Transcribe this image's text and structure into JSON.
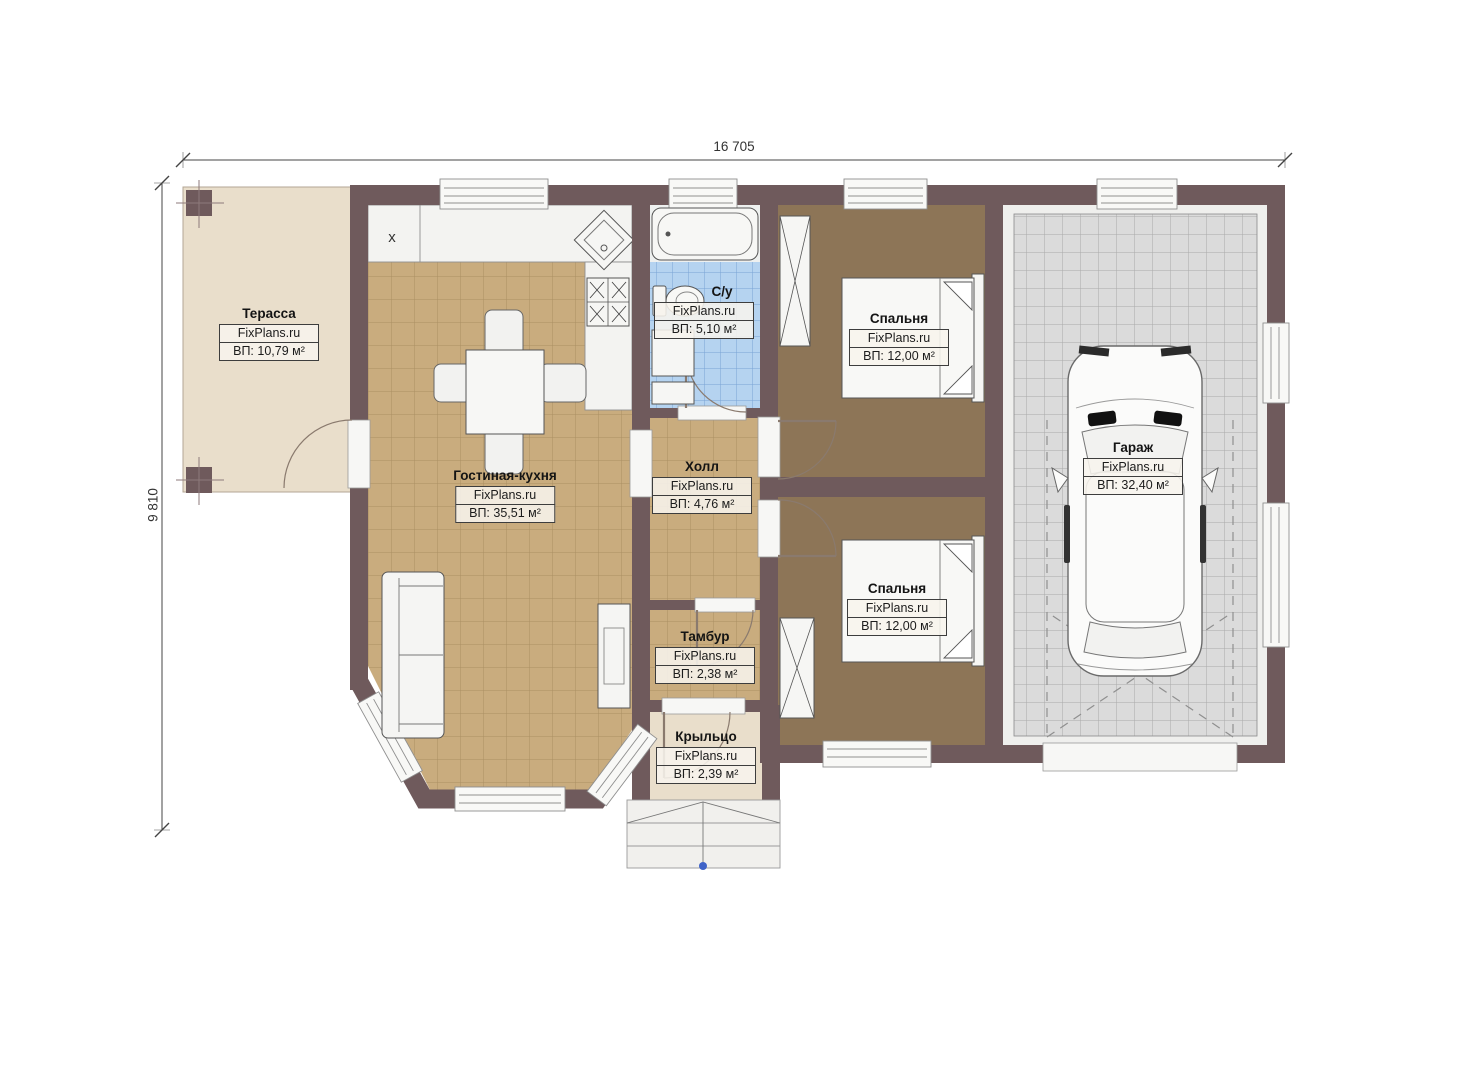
{
  "plan": {
    "brand": "FixPlans.ru",
    "dimensions": {
      "width_label": "16 705",
      "height_label": "9 810"
    },
    "kitchen_marker": "x",
    "rooms": [
      {
        "id": "terrace",
        "name": "Терасса",
        "brand": "FixPlans.ru",
        "area": "ВП: 10,79 м²"
      },
      {
        "id": "living-kitchen",
        "name": "Гостиная-кухня",
        "brand": "FixPlans.ru",
        "area": "ВП: 35,51 м²"
      },
      {
        "id": "bathroom",
        "name": "С/у",
        "brand": "FixPlans.ru",
        "area": "ВП: 5,10 м²"
      },
      {
        "id": "hall",
        "name": "Холл",
        "brand": "FixPlans.ru",
        "area": "ВП: 4,76 м²"
      },
      {
        "id": "bedroom-1",
        "name": "Спальня",
        "brand": "FixPlans.ru",
        "area": "ВП: 12,00 м²"
      },
      {
        "id": "bedroom-2",
        "name": "Спальня",
        "brand": "FixPlans.ru",
        "area": "ВП: 12,00 м²"
      },
      {
        "id": "garage",
        "name": "Гараж",
        "brand": "FixPlans.ru",
        "area": "ВП: 32,40 м²"
      },
      {
        "id": "vestibule",
        "name": "Тамбур",
        "brand": "FixPlans.ru",
        "area": "ВП: 2,38 м²"
      },
      {
        "id": "porch",
        "name": "Крыльцо",
        "brand": "FixPlans.ru",
        "area": "ВП: 2,39 м²"
      }
    ],
    "colors": {
      "wall": "#6f5a5c",
      "living_floor": "#c9ac7e",
      "bedroom_floor": "#8d7557",
      "garage_floor": "#dbdbdb",
      "bath_floor": "#b5d3f0",
      "terrace_floor": "#e9decb",
      "riser_orange": "#e8823b",
      "step_marker_blue": "#3f63c8"
    }
  }
}
